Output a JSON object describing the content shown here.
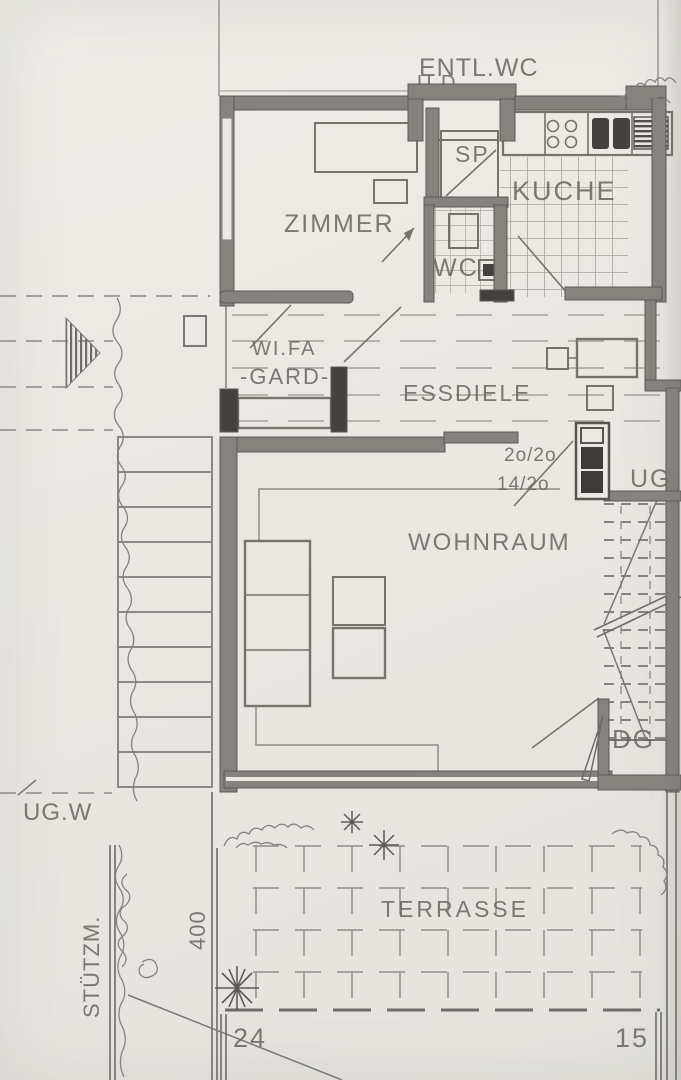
{
  "meta": {
    "title": "Hand-drawn architectural floor plan (pencil on paper)",
    "language": "German"
  },
  "colors": {
    "paper": "#ebe9e4",
    "pencil": "#76736d",
    "pencil_light": "#9a9893",
    "wall_fill": "#85837e",
    "dark_fill": "#413f3b"
  },
  "rooms": {
    "entl_wc": "ENTL.WC",
    "porch_note": "U.D.",
    "zimmer": "ZIMMER",
    "sp": "SP",
    "kueche": "KUCHE",
    "wc": "WC",
    "wifa": "WI.FA",
    "gard": "-GARD-",
    "essdiele": "ESSDIELE",
    "wohnraum": "WOHNRAUM",
    "terrasse": "TERRASSE"
  },
  "annotations": {
    "stair_dim_1": "2o/2o",
    "stair_dim_2": "14/2o",
    "ug": "UG",
    "dg": "DG",
    "ug_w": "UG.W",
    "stuetzmauer": "STÜTZM.",
    "dim_400": "400",
    "dim_24": "24",
    "dim_15": "15"
  }
}
